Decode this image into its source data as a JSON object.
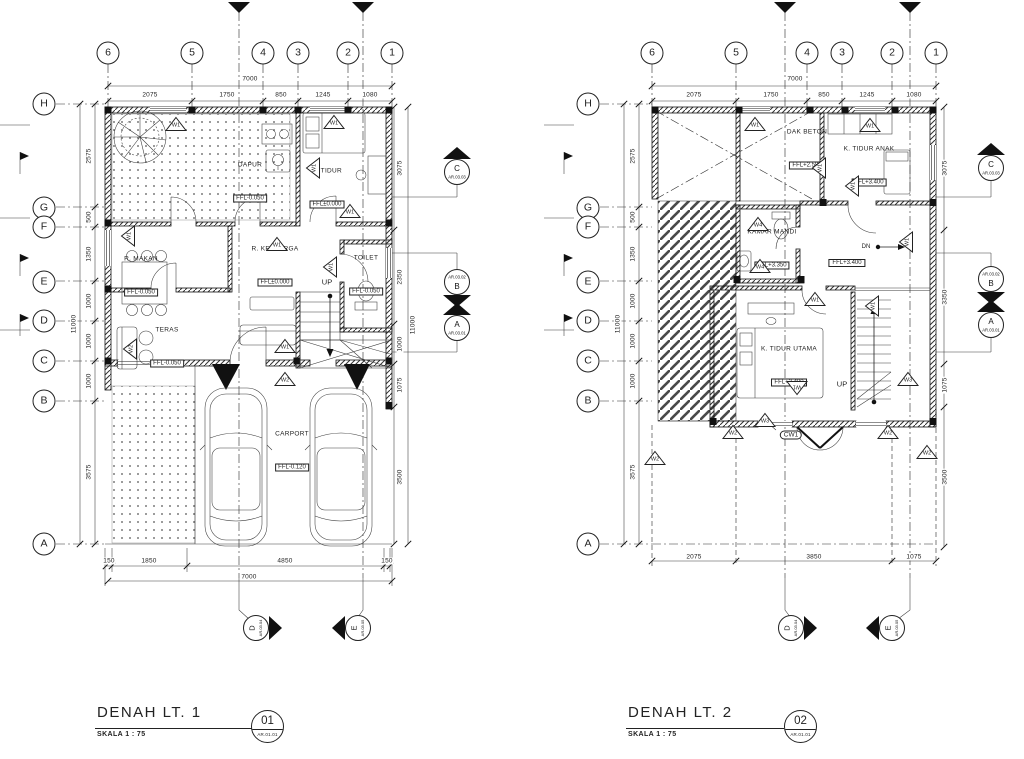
{
  "theme": {
    "paper": "#ffffff",
    "ink": "#1f1f1f"
  },
  "plans": [
    {
      "title": "DENAH LT. 1",
      "scale_label": "SKALA 1 : 75",
      "sheet_no": "01",
      "sheet_code": "AR.01.01",
      "grid_bubbles": [
        {
          "label": "6",
          "x": 108,
          "y": 53
        },
        {
          "label": "5",
          "x": 192,
          "y": 53
        },
        {
          "label": "4",
          "x": 263,
          "y": 53
        },
        {
          "label": "3",
          "x": 298,
          "y": 53
        },
        {
          "label": "2",
          "x": 348,
          "y": 53
        },
        {
          "label": "1",
          "x": 392,
          "y": 53
        },
        {
          "label": "H",
          "x": 44,
          "y": 104
        },
        {
          "label": "G",
          "x": 44,
          "y": 208
        },
        {
          "label": "F",
          "x": 44,
          "y": 227
        },
        {
          "label": "E",
          "x": 44,
          "y": 282
        },
        {
          "label": "D",
          "x": 44,
          "y": 321
        },
        {
          "label": "C",
          "x": 44,
          "y": 361
        },
        {
          "label": "B",
          "x": 44,
          "y": 401
        },
        {
          "label": "A",
          "x": 44,
          "y": 544
        }
      ],
      "dimensions": [
        {
          "label": "7000",
          "x": 250,
          "y": 79
        },
        {
          "label": "2075",
          "x": 150,
          "y": 95
        },
        {
          "label": "1750",
          "x": 227,
          "y": 95
        },
        {
          "label": "850",
          "x": 281,
          "y": 95
        },
        {
          "label": "1245",
          "x": 323,
          "y": 95
        },
        {
          "label": "1080",
          "x": 370,
          "y": 95
        },
        {
          "label": "2575",
          "x": 89,
          "y": 156,
          "rot": -90
        },
        {
          "label": "500",
          "x": 89,
          "y": 217,
          "rot": -90
        },
        {
          "label": "1350",
          "x": 89,
          "y": 254,
          "rot": -90
        },
        {
          "label": "1000",
          "x": 89,
          "y": 301,
          "rot": -90
        },
        {
          "label": "1000",
          "x": 89,
          "y": 341,
          "rot": -90
        },
        {
          "label": "1000",
          "x": 89,
          "y": 381,
          "rot": -90
        },
        {
          "label": "3575",
          "x": 89,
          "y": 472,
          "rot": -90
        },
        {
          "label": "11000",
          "x": 74,
          "y": 324,
          "rot": -90
        },
        {
          "label": "3075",
          "x": 400,
          "y": 168,
          "rot": -90
        },
        {
          "label": "2350",
          "x": 400,
          "y": 277,
          "rot": -90
        },
        {
          "label": "1000",
          "x": 400,
          "y": 344,
          "rot": -90
        },
        {
          "label": "1075",
          "x": 400,
          "y": 385,
          "rot": -90
        },
        {
          "label": "3500",
          "x": 400,
          "y": 477,
          "rot": -90
        },
        {
          "label": "11000",
          "x": 413,
          "y": 325,
          "rot": -90
        },
        {
          "label": "150",
          "x": 109,
          "y": 561
        },
        {
          "label": "1850",
          "x": 149,
          "y": 561
        },
        {
          "label": "4850",
          "x": 285,
          "y": 561
        },
        {
          "label": "150",
          "x": 387,
          "y": 561
        },
        {
          "label": "7000",
          "x": 249,
          "y": 577
        }
      ],
      "rooms": [
        {
          "name": "DAPUR",
          "ffl": "FFL-0.050",
          "x": 250,
          "y": 183
        },
        {
          "name": "K. TIDUR",
          "ffl": "FFL±0.000",
          "x": 327,
          "y": 189
        },
        {
          "name": "R. MAKAN",
          "ffl": "FFL-0.050",
          "x": 141,
          "y": 277
        },
        {
          "name": "R. KELUARGA",
          "ffl": "FFL±0.000",
          "x": 275,
          "y": 267
        },
        {
          "name": "TOILET",
          "ffl": "FFL-0.050",
          "x": 366,
          "y": 276
        },
        {
          "name": "TERAS",
          "ffl": "FFL-0.050",
          "x": 167,
          "y": 348
        },
        {
          "name": "CARPORT",
          "ffl": "FFL-0.120",
          "x": 292,
          "y": 452
        }
      ],
      "annotations": [
        {
          "label": "UP",
          "x": 327,
          "y": 282,
          "size": 7.5
        }
      ],
      "window_markers": [
        {
          "label": "W1",
          "x": 176,
          "y": 124
        },
        {
          "label": "W1",
          "x": 334,
          "y": 122
        },
        {
          "label": "W1",
          "x": 313,
          "y": 168,
          "rot": -90
        },
        {
          "label": "W1",
          "x": 128,
          "y": 236,
          "rot": -90
        },
        {
          "label": "W1",
          "x": 277,
          "y": 244
        },
        {
          "label": "W1",
          "x": 350,
          "y": 211
        },
        {
          "label": "W1",
          "x": 330,
          "y": 267,
          "rot": -90
        },
        {
          "label": "W2",
          "x": 130,
          "y": 349,
          "rot": -90
        },
        {
          "label": "W1",
          "x": 285,
          "y": 346
        },
        {
          "label": "W2",
          "x": 285,
          "y": 379
        }
      ],
      "section_markers": [
        {
          "letter": "C",
          "code": "AR.03.03",
          "x": 457,
          "y": 167,
          "dir": "up"
        },
        {
          "letter": "B",
          "code": "AR.03.02",
          "x": 457,
          "y": 287,
          "dir": "down"
        },
        {
          "let​ter": "-",
          "letter": "A",
          "code": "AR.03.01",
          "x": 457,
          "y": 323,
          "dir": "up"
        },
        {
          "letter": "D",
          "code": "AR.03.04",
          "x": 262,
          "y": 628,
          "dir": "right"
        },
        {
          "letter": "E",
          "code": "AR.03.05",
          "x": 352,
          "y": 628,
          "dir": "left"
        }
      ]
    },
    {
      "title": "DENAH LT. 2",
      "scale_label": "SKALA 1 : 75",
      "sheet_no": "02",
      "sheet_code": "AR.01.01",
      "grid_bubbles": [
        {
          "label": "6",
          "x": 652,
          "y": 53
        },
        {
          "label": "5",
          "x": 736,
          "y": 53
        },
        {
          "label": "4",
          "x": 807,
          "y": 53
        },
        {
          "label": "3",
          "x": 842,
          "y": 53
        },
        {
          "label": "2",
          "x": 892,
          "y": 53
        },
        {
          "label": "1",
          "x": 936,
          "y": 53
        },
        {
          "label": "H",
          "x": 588,
          "y": 104
        },
        {
          "label": "G",
          "x": 588,
          "y": 208
        },
        {
          "label": "F",
          "x": 588,
          "y": 227
        },
        {
          "label": "E",
          "x": 588,
          "y": 282
        },
        {
          "label": "D",
          "x": 588,
          "y": 321
        },
        {
          "label": "C",
          "x": 588,
          "y": 361
        },
        {
          "label": "B",
          "x": 588,
          "y": 401
        },
        {
          "label": "A",
          "x": 588,
          "y": 544
        }
      ],
      "dimensions": [
        {
          "label": "7000",
          "x": 795,
          "y": 79
        },
        {
          "label": "2075",
          "x": 694,
          "y": 95
        },
        {
          "label": "1750",
          "x": 771,
          "y": 95
        },
        {
          "label": "850",
          "x": 824,
          "y": 95
        },
        {
          "label": "1245",
          "x": 867,
          "y": 95
        },
        {
          "label": "1080",
          "x": 914,
          "y": 95
        },
        {
          "label": "2575",
          "x": 633,
          "y": 156,
          "rot": -90
        },
        {
          "label": "500",
          "x": 633,
          "y": 217,
          "rot": -90
        },
        {
          "label": "1350",
          "x": 633,
          "y": 254,
          "rot": -90
        },
        {
          "label": "1000",
          "x": 633,
          "y": 301,
          "rot": -90
        },
        {
          "label": "1000",
          "x": 633,
          "y": 341,
          "rot": -90
        },
        {
          "label": "1000",
          "x": 633,
          "y": 381,
          "rot": -90
        },
        {
          "label": "3575",
          "x": 633,
          "y": 472,
          "rot": -90
        },
        {
          "label": "11000",
          "x": 618,
          "y": 324,
          "rot": -90
        },
        {
          "label": "3075",
          "x": 945,
          "y": 168,
          "rot": -90
        },
        {
          "label": "3350",
          "x": 945,
          "y": 297,
          "rot": -90
        },
        {
          "label": "1075",
          "x": 945,
          "y": 385,
          "rot": -90
        },
        {
          "label": "3500",
          "x": 945,
          "y": 477,
          "rot": -90
        },
        {
          "label": "2075",
          "x": 694,
          "y": 557
        },
        {
          "label": "3850",
          "x": 814,
          "y": 557
        },
        {
          "label": "1075",
          "x": 914,
          "y": 557
        }
      ],
      "rooms": [
        {
          "name": "DAK BETON",
          "ffl": "FFL+2.580",
          "x": 807,
          "y": 150
        },
        {
          "name": "K. TIDUR ANAK",
          "ffl": "FFL+3.400",
          "x": 869,
          "y": 167
        },
        {
          "name": "KAMAR MANDI",
          "ffl": "FFL+3.350",
          "x": 772,
          "y": 250
        },
        {
          "name": "K. TIDUR UTAMA",
          "ffl": "FFL+3.400",
          "x": 789,
          "y": 367
        }
      ],
      "annotations": [
        {
          "label": "FFL+3.400",
          "x": 847,
          "y": 263,
          "boxed": true,
          "size": 6
        },
        {
          "label": "UP",
          "x": 842,
          "y": 384,
          "size": 7.5
        },
        {
          "label": "DN",
          "x": 866,
          "y": 247,
          "size": 6
        },
        {
          "label": "CW1",
          "x": 791,
          "y": 435,
          "boxed": true,
          "rounded": true,
          "size": 6.5
        }
      ],
      "window_markers": [
        {
          "label": "W1",
          "x": 755,
          "y": 124
        },
        {
          "label": "W1",
          "x": 870,
          "y": 125
        },
        {
          "label": "W1",
          "x": 819,
          "y": 168,
          "rot": -90
        },
        {
          "label": "W1",
          "x": 852,
          "y": 186,
          "rot": -90
        },
        {
          "label": "W4",
          "x": 758,
          "y": 224
        },
        {
          "label": "W4",
          "x": 760,
          "y": 266
        },
        {
          "label": "W1",
          "x": 815,
          "y": 299
        },
        {
          "label": "W1",
          "x": 872,
          "y": 306,
          "rot": -90
        },
        {
          "label": "W1",
          "x": 906,
          "y": 242,
          "rot": -90
        },
        {
          "label": "W1",
          "x": 797,
          "y": 388,
          "rot": 180
        },
        {
          "label": "W3",
          "x": 908,
          "y": 379
        },
        {
          "label": "W3",
          "x": 765,
          "y": 420
        },
        {
          "label": "W2",
          "x": 733,
          "y": 432
        },
        {
          "label": "W2",
          "x": 888,
          "y": 432
        },
        {
          "label": "W2",
          "x": 655,
          "y": 458
        },
        {
          "label": "W2",
          "x": 927,
          "y": 452
        }
      ],
      "section_markers": [
        {
          "letter": "C",
          "code": "AR.03.03",
          "x": 991,
          "y": 163,
          "dir": "up"
        },
        {
          "letter": "B",
          "code": "AR.03.02",
          "x": 991,
          "y": 284,
          "dir": "down"
        },
        {
          "letter": "A",
          "code": "AR.03.01",
          "x": 991,
          "y": 320,
          "dir": "up"
        },
        {
          "letter": "D",
          "code": "AR.03.04",
          "x": 797,
          "y": 628,
          "dir": "right"
        },
        {
          "letter": "E",
          "code": "AR.03.05",
          "x": 886,
          "y": 628,
          "dir": "left"
        }
      ]
    }
  ]
}
